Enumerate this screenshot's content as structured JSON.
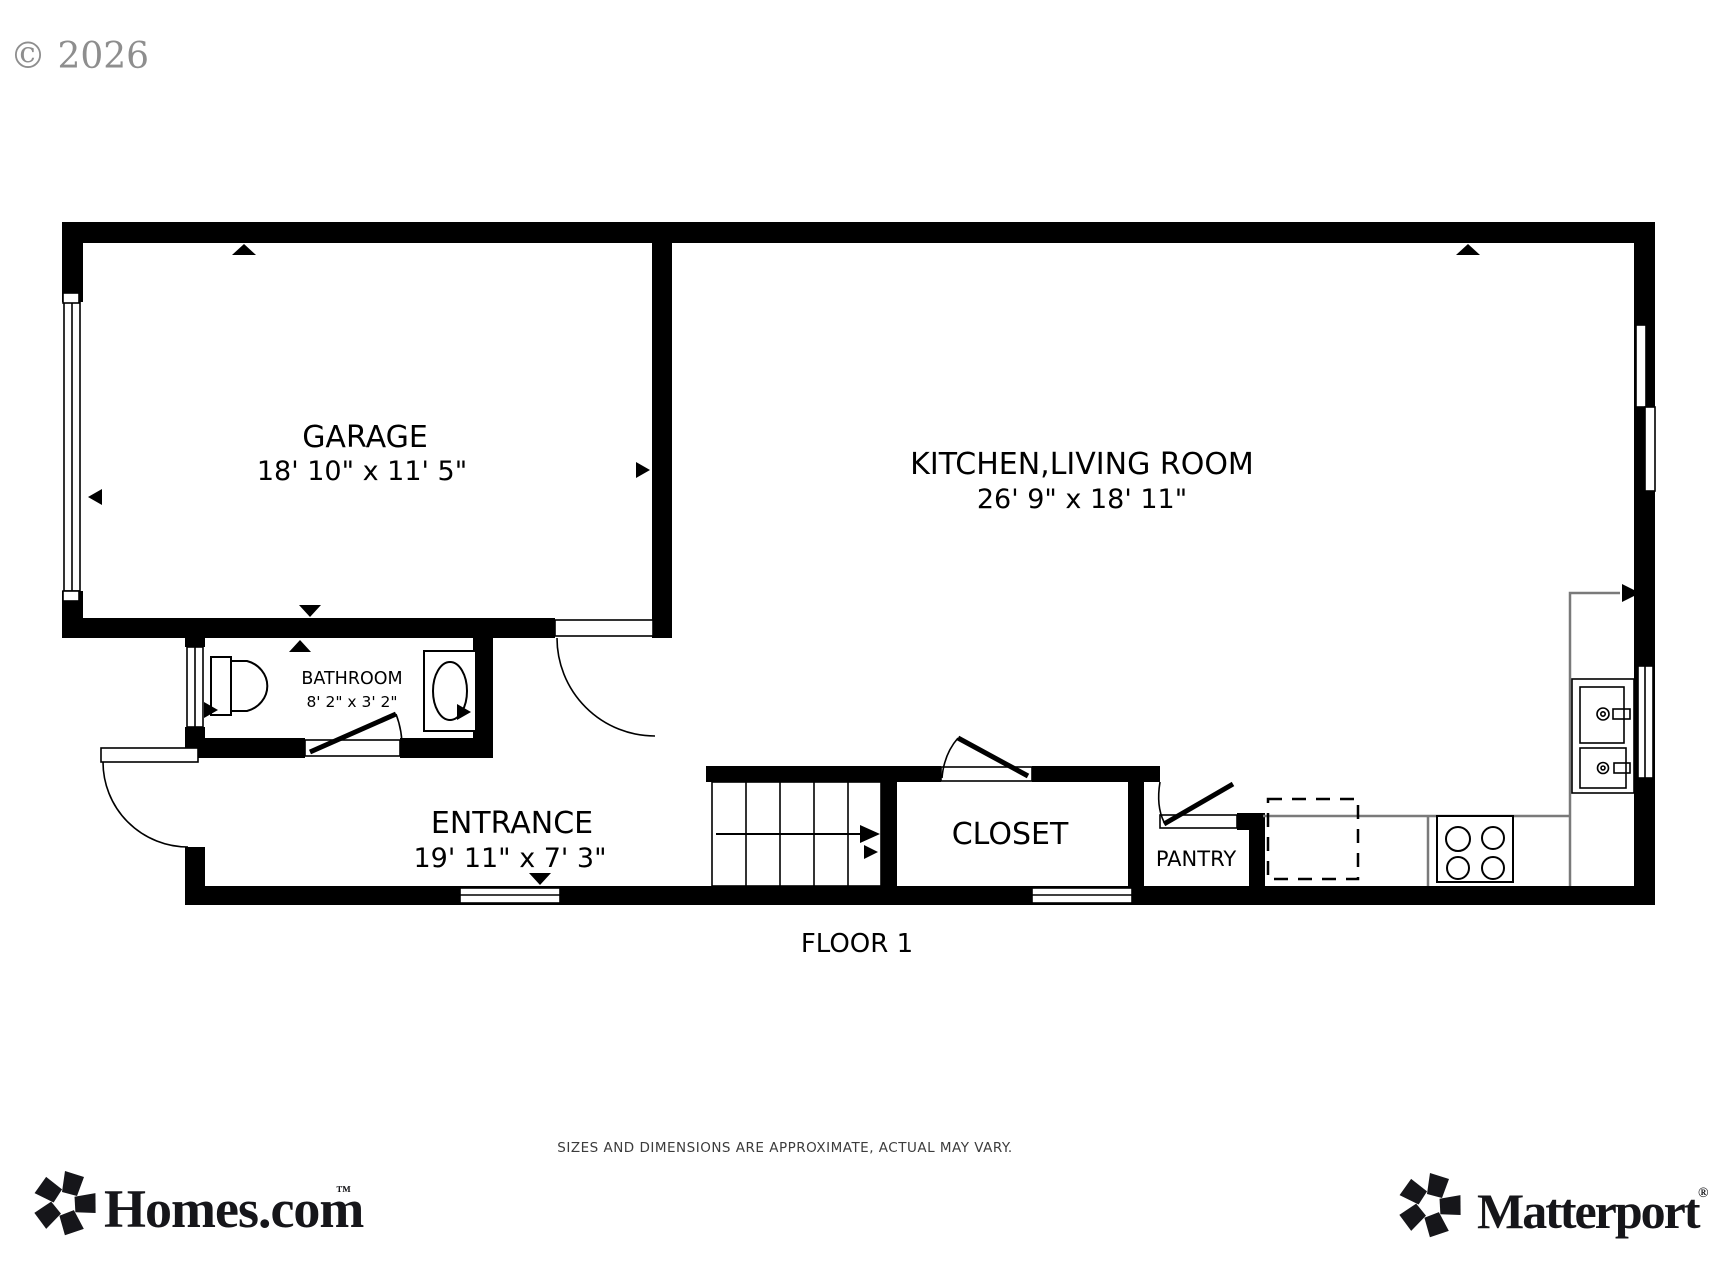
{
  "watermark": "© 2026",
  "plan": {
    "floor_label": "FLOOR 1",
    "rooms": {
      "garage": {
        "name": "GARAGE",
        "dims": "18' 10\" x 11' 5\""
      },
      "kitchen_living": {
        "name": "KITCHEN,LIVING ROOM",
        "dims": "26' 9\" x 18' 11\""
      },
      "bathroom": {
        "name": "BATHROOM",
        "dims": "8' 2\" x 3' 2\""
      },
      "entrance": {
        "name": "ENTRANCE",
        "dims": "19' 11\" x 7' 3\""
      },
      "closet": {
        "name": "CLOSET"
      },
      "pantry": {
        "name": "PANTRY"
      }
    }
  },
  "footer": {
    "homes_logo": "Homes.com",
    "homes_trademark": "™",
    "matterport_logo": "Matterport",
    "matterport_trademark": "®",
    "disclaimer": "SIZES AND DIMENSIONS ARE APPROXIMATE, ACTUAL MAY VARY."
  },
  "colors": {
    "wall": "#000000",
    "counter": "#7a7a7a",
    "watermark": "#8e8e8e"
  }
}
